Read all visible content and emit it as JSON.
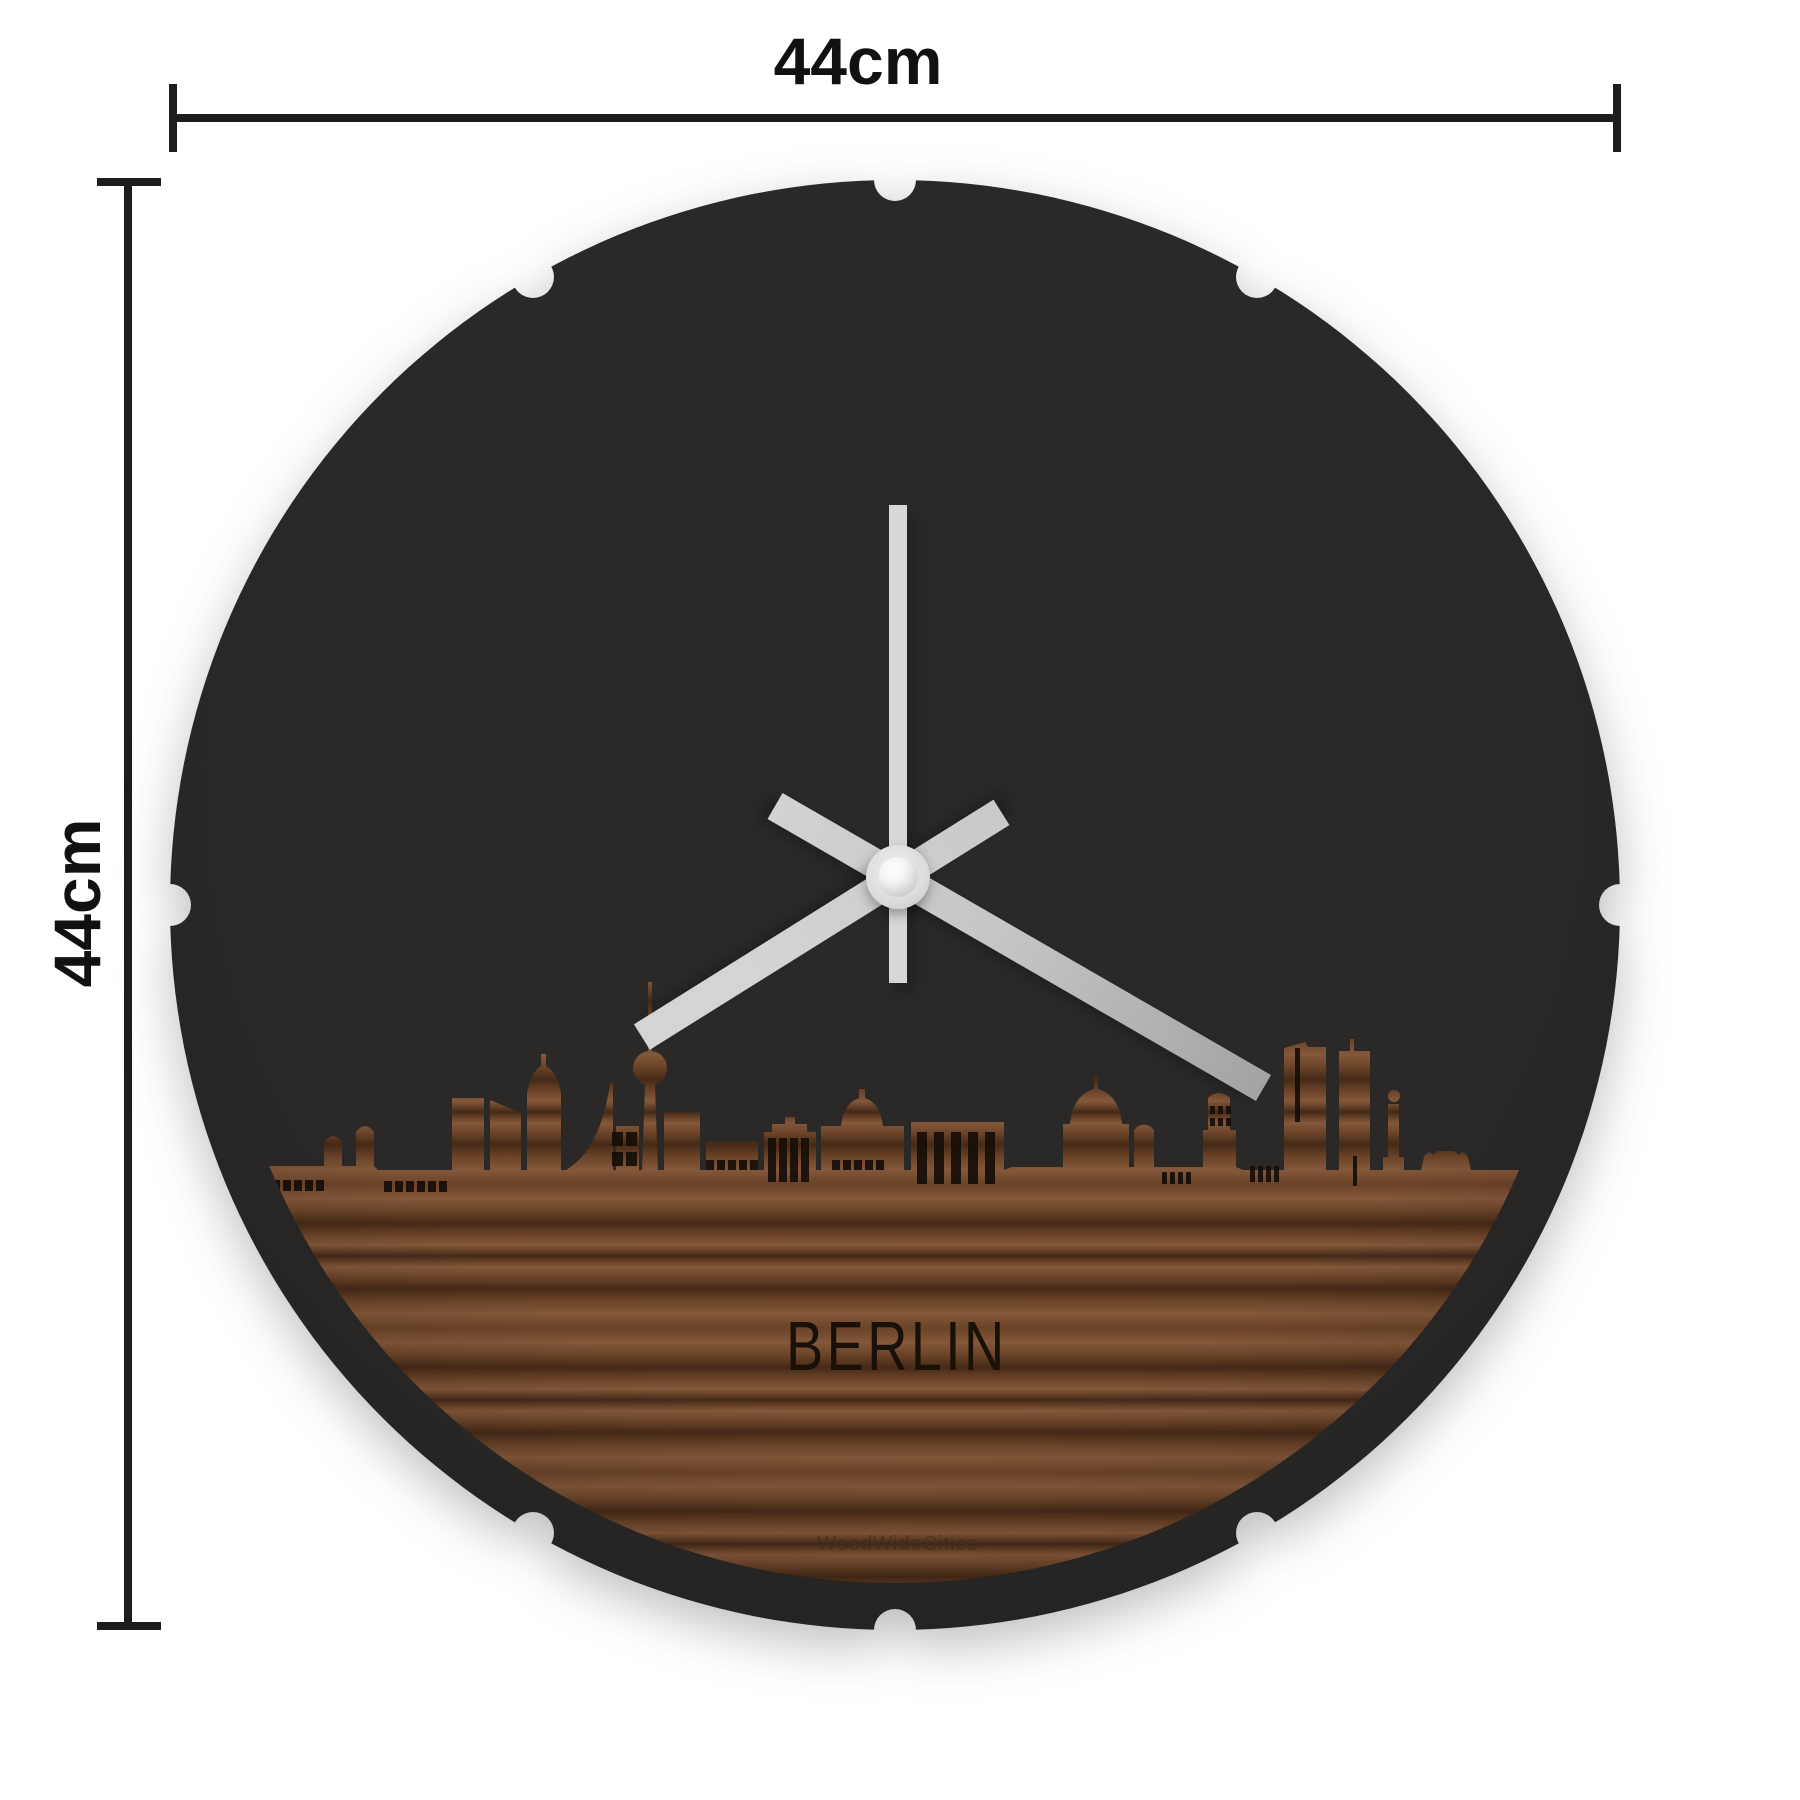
{
  "annotations": {
    "width_label": "44cm",
    "height_label": "44cm"
  },
  "clock": {
    "city_label": "BERLIN",
    "watermark": "WoodWideCities",
    "diameter_cm": 44,
    "time": {
      "hour_deg": 238,
      "minute_deg": 120,
      "second_deg": 0
    },
    "colors": {
      "face": "#2a2928",
      "second_hand": "#d7d7d7",
      "hour_hand": "#d4d4d4",
      "minute_hand": "#b0b0b0",
      "hub": "#dcdcdc",
      "wood_light": "#84583a",
      "wood_mid": "#6a4328",
      "wood_dark": "#462917",
      "engraving": "#160e08",
      "dimension_lines": "#1d1d1d"
    }
  }
}
